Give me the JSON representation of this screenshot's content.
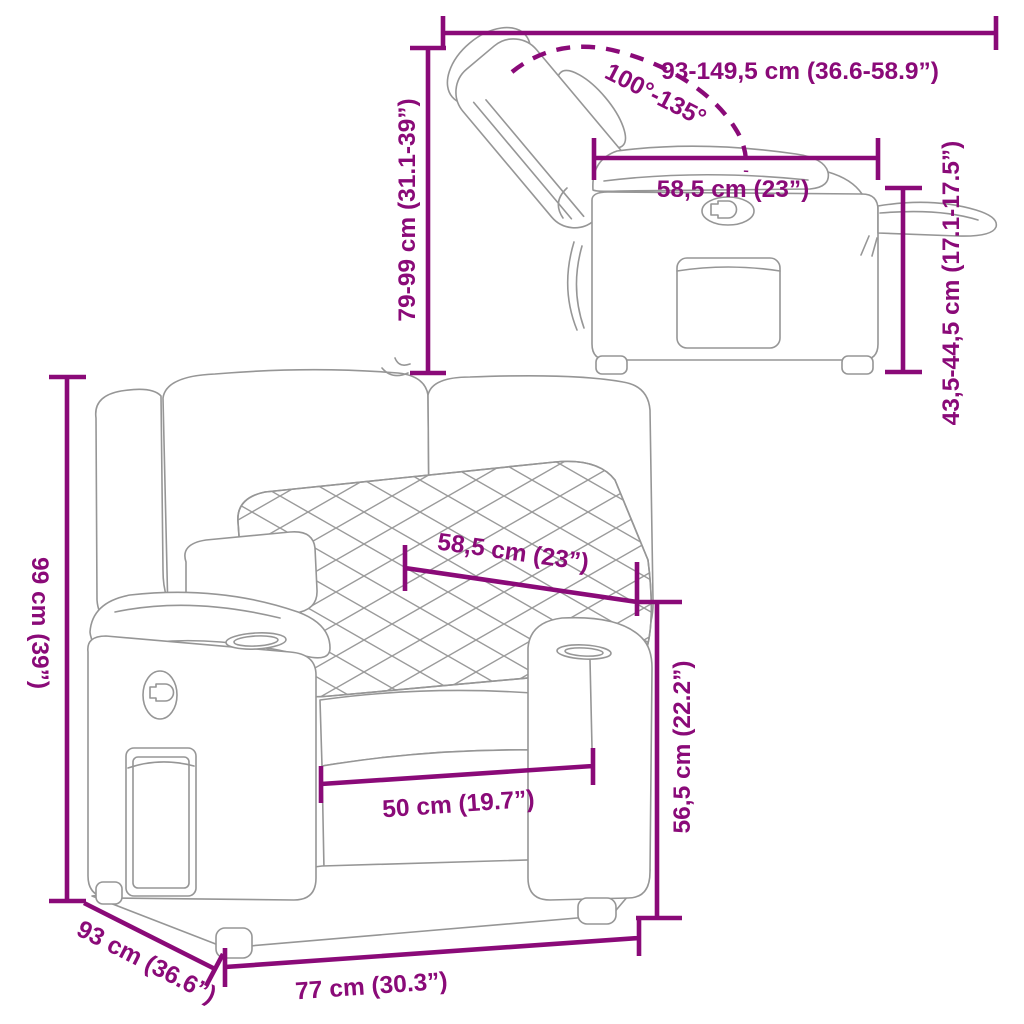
{
  "colors": {
    "accent": "#8A0A78",
    "illustration_line": "#969696",
    "background": "#ffffff"
  },
  "side_view": {
    "depth_range_label": "93-149,5 cm (36.6-58.9”)",
    "recline_angle_label": "100°-135°",
    "height_range_label": "79-99 cm (31.1-39”)",
    "seat_width_label": "58,5 cm (23”)",
    "footrest_height_label": "43,5-44,5 cm (17.1-17.5”)"
  },
  "front_view": {
    "height_label": "99 cm (39”)",
    "backrest_width_label": "58,5 cm (23”)",
    "seat_back_height_label": "56,5 cm (22.2”)",
    "seat_width_label": "50 cm (19.7”)",
    "overall_width_label": "77 cm (30.3”)",
    "overall_depth_label": "93 cm (36.6”)"
  }
}
